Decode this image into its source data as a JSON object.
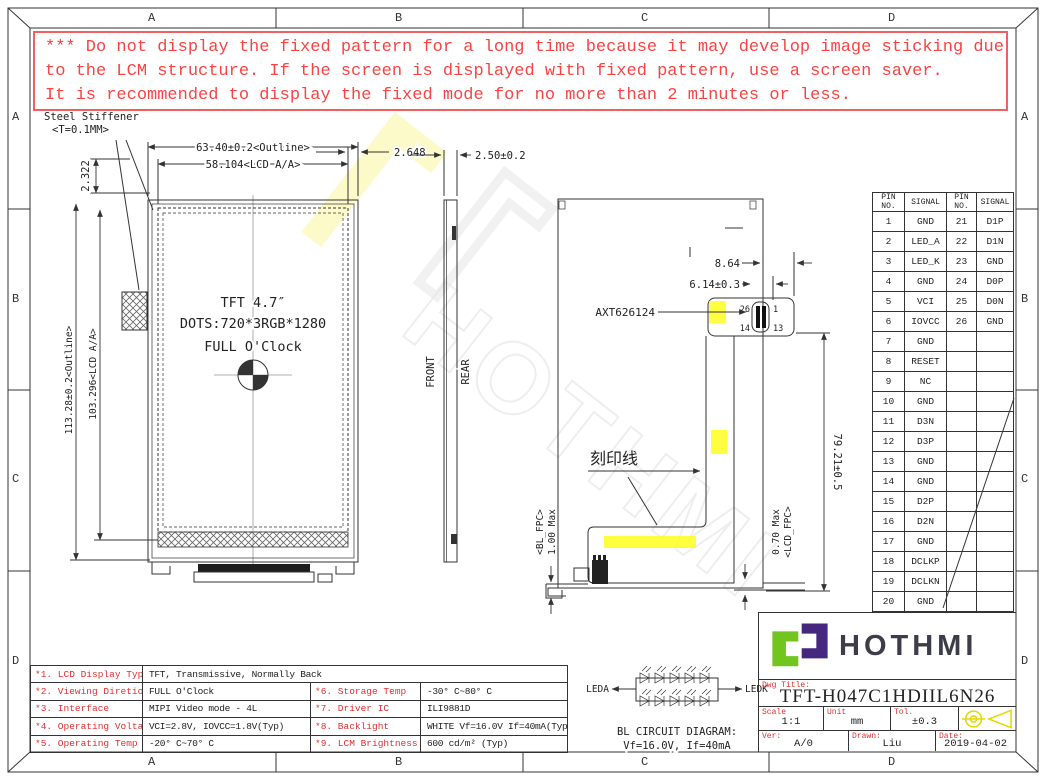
{
  "sheet": {
    "grid_letters": [
      "A",
      "B",
      "C",
      "D"
    ]
  },
  "warning": {
    "lines": [
      "*** Do not display the fixed pattern for a long time because it may develop image sticking due",
      "to the LCM structure. If the screen is displayed with fixed pattern, use a screen saver.",
      "It is recommended to display the fixed mode for no more than 2 minutes or less."
    ]
  },
  "front_view": {
    "stiffener_line1": "Steel Stiffener",
    "stiffener_line2": "<T=0.1MM>",
    "dim_outline_w": "63.40±0.2<Outline>",
    "dim_aa_w": "58.104<LCD A/A>",
    "dim_gap_w": "2.648",
    "dim_gap_h": "2.322",
    "dim_outline_h": "113.28±0.2<Outline>",
    "dim_aa_h": "103.296<LCD A/A>",
    "center_line1": "TFT 4.7″",
    "center_line2": "DOTS:720*3RGB*1280",
    "center_line3": "FULL O'Clock"
  },
  "side_view": {
    "dim_thickness": "2.50±0.2",
    "front_label": "FRONT",
    "rear_label": "REAR"
  },
  "rear_view": {
    "dim_tab": "8.64",
    "dim_connector": "6.14±0.3",
    "connector_part": "AXT626124",
    "pin_top_left": "26",
    "pin_top_right": "1",
    "pin_bottom_left": "14",
    "pin_bottom_right": "13",
    "dim_fpc_length": "79.21±0.5",
    "engraving_label": "刻印线",
    "bl_fpc_thickness": "1.00 Max",
    "bl_fpc_label": "<BL_FPC>",
    "lcd_fpc_thickness": "0.70 Max",
    "lcd_fpc_label": "<LCD_FPC>"
  },
  "pin_table": {
    "headers": [
      "PIN NO.",
      "SIGNAL",
      "PIN NO.",
      "SIGNAL"
    ],
    "rows_left": [
      [
        "1",
        "GND"
      ],
      [
        "2",
        "LED_A"
      ],
      [
        "3",
        "LED_K"
      ],
      [
        "4",
        "GND"
      ],
      [
        "5",
        "VCI"
      ],
      [
        "6",
        "IOVCC"
      ],
      [
        "7",
        "GND"
      ],
      [
        "8",
        "RESET"
      ],
      [
        "9",
        "NC"
      ],
      [
        "10",
        "GND"
      ],
      [
        "11",
        "D3N"
      ],
      [
        "12",
        "D3P"
      ],
      [
        "13",
        "GND"
      ],
      [
        "14",
        "GND"
      ],
      [
        "15",
        "D2P"
      ],
      [
        "16",
        "D2N"
      ],
      [
        "17",
        "GND"
      ],
      [
        "18",
        "DCLKP"
      ],
      [
        "19",
        "DCLKN"
      ],
      [
        "20",
        "GND"
      ]
    ],
    "rows_right": [
      [
        "21",
        "D1P"
      ],
      [
        "22",
        "D1N"
      ],
      [
        "23",
        "GND"
      ],
      [
        "24",
        "D0P"
      ],
      [
        "25",
        "D0N"
      ],
      [
        "26",
        "GND"
      ]
    ]
  },
  "spec_table": {
    "row1": {
      "label": "*1. LCD Display Type",
      "value": "TFT, Transmissive, Normally Back"
    },
    "left_rows": [
      {
        "label": "*2. Viewing Diretion",
        "value": "FULL O'Clock"
      },
      {
        "label": "*3. Interface",
        "value": "MIPI Video mode - 4L"
      },
      {
        "label": "*4. Operating Voltage",
        "value": "VCI=2.8V, IOVCC=1.8V(Typ)"
      },
      {
        "label": "*5. Operating Temp",
        "value": "-20° C~70° C"
      }
    ],
    "right_rows": [
      {
        "label": "*6. Storage Temp",
        "value": "-30° C~80° C"
      },
      {
        "label": "*7. Driver IC",
        "value": "ILI9881D"
      },
      {
        "label": "*8. Backlight",
        "value": "WHITE Vf=16.0V If=40mA(Typ)"
      },
      {
        "label": "*9. LCM Brightness",
        "value": "600 cd/m² (Typ)"
      }
    ]
  },
  "bl_circuit": {
    "left_label": "LEDA",
    "right_label": "LEDK",
    "caption_line1": "BL CIRCUIT DIAGRAM:",
    "caption_line2": "Vf=16.0V, If=40mA",
    "leds_per_row": 5,
    "rows": 2
  },
  "title_block": {
    "brand": "HOTHMI",
    "dwg_title_label": "Dwg Title:",
    "dwg_title": "TFT-H047C1HDIIL6N26",
    "scale_label": "Scale",
    "scale_value": "1:1",
    "unit_label": "Unit",
    "unit_value": "mm",
    "tol_label": "Tol.",
    "tol_value": "±0.3",
    "ver_label": "Ver:",
    "ver_value": "A/0",
    "drawn_label": "Drawn:",
    "drawn_value": "Liu",
    "date_label": "Date:",
    "date_value": "2019-04-02"
  },
  "colors": {
    "warning_red": "#fa4343",
    "label_red": "#e03030",
    "highlight_yellow": "#ffff00",
    "logo_green": "#72c41e",
    "logo_purple": "#45277d"
  }
}
